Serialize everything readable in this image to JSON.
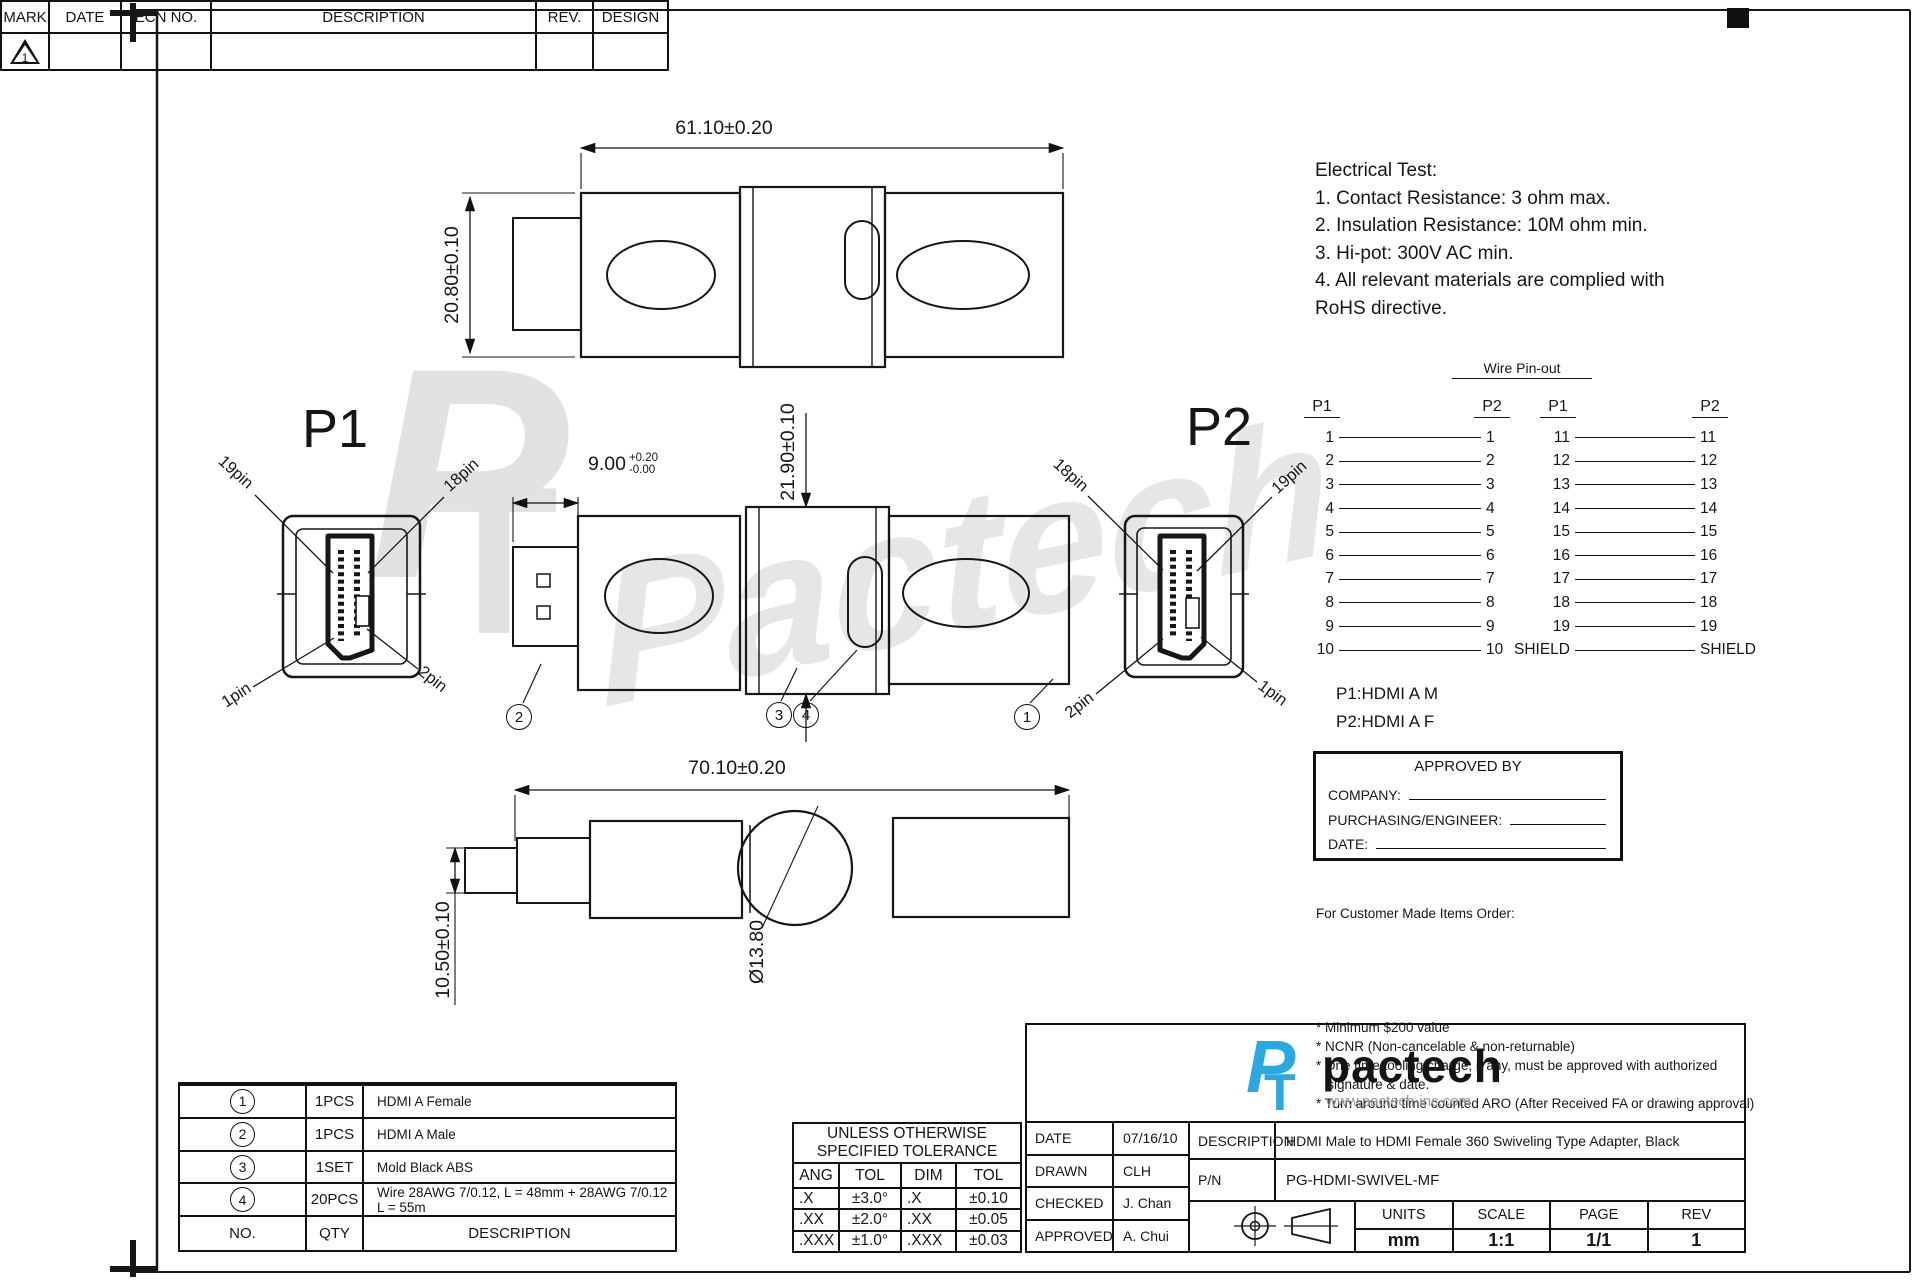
{
  "revision_table": {
    "headers": [
      "MARK",
      "DATE",
      "ECN NO.",
      "DESCRIPTION",
      "REV.",
      "DESIGN"
    ],
    "mark_value": "1"
  },
  "electrical_test": {
    "title": "Electrical Test:",
    "lines": [
      "1. Contact Resistance: 3 ohm max.",
      "2. Insulation Resistance: 10M ohm min.",
      "3. Hi-pot: 300V AC min.",
      "4. All relevant materials are complied with",
      "RoHS directive."
    ]
  },
  "views": {
    "p1_label": "P1",
    "p2_label": "P2",
    "p1_pins": {
      "top_left": "19pin",
      "top_right": "18pin",
      "bottom_left": "1pin",
      "bottom_right": "2pin"
    },
    "p2_pins": {
      "top_left": "18pin",
      "top_right": "19pin",
      "bottom_left": "2pin",
      "bottom_right": "1pin"
    },
    "dims": {
      "top_length": "61.10±0.20",
      "front_height": "20.80±0.10",
      "plug_main": "9.00",
      "plug_tol_up": "+0.20",
      "plug_tol_dn": "-0.00",
      "joint_height": "21.90±0.10",
      "overall_length": "70.10±0.20",
      "tail_height": "10.50±0.10",
      "knob_dia": "Ø13.80"
    },
    "balloons": {
      "b1": "1",
      "b2": "2",
      "b3": "3",
      "b4": "4"
    }
  },
  "wire_pinout": {
    "title": "Wire Pin-out",
    "headers": {
      "left_a": "P1",
      "right_a": "P2",
      "left_b": "P1",
      "right_b": "P2"
    },
    "group_a": [
      {
        "l": "1",
        "r": "1"
      },
      {
        "l": "2",
        "r": "2"
      },
      {
        "l": "3",
        "r": "3"
      },
      {
        "l": "4",
        "r": "4"
      },
      {
        "l": "5",
        "r": "5"
      },
      {
        "l": "6",
        "r": "6"
      },
      {
        "l": "7",
        "r": "7"
      },
      {
        "l": "8",
        "r": "8"
      },
      {
        "l": "9",
        "r": "9"
      },
      {
        "l": "10",
        "r": "10"
      }
    ],
    "group_b": [
      {
        "l": "11",
        "r": "11"
      },
      {
        "l": "12",
        "r": "12"
      },
      {
        "l": "13",
        "r": "13"
      },
      {
        "l": "14",
        "r": "14"
      },
      {
        "l": "15",
        "r": "15"
      },
      {
        "l": "16",
        "r": "16"
      },
      {
        "l": "17",
        "r": "17"
      },
      {
        "l": "18",
        "r": "18"
      },
      {
        "l": "19",
        "r": "19"
      },
      {
        "l": "SHIELD",
        "r": "SHIELD"
      }
    ],
    "legend_p1": "P1:HDMI A M",
    "legend_p2": "P2:HDMI A F"
  },
  "approval": {
    "title": "APPROVED BY",
    "company_label": "COMPANY:",
    "purchasing_label": "PURCHASING/ENGINEER:",
    "date_label": "DATE:"
  },
  "order_notes": {
    "title": "For Customer Made Items Order:",
    "items": [
      "* Minimum $200 value",
      "* NCNR (Non-cancelable & non-returnable)",
      "* One time tooling charge, if any, must be approved with authorized",
      "   signature & date.",
      "* Turn around time counted ARO (After Received FA or drawing approval)"
    ]
  },
  "bom": {
    "rows": [
      {
        "no": "4",
        "qty": "20PCS",
        "desc": "Wire 28AWG 7/0.12, L = 48mm + 28AWG 7/0.12 L = 55m"
      },
      {
        "no": "3",
        "qty": "1SET",
        "desc": "Mold Black ABS"
      },
      {
        "no": "2",
        "qty": "1PCS",
        "desc": "HDMI A Male"
      },
      {
        "no": "1",
        "qty": "1PCS",
        "desc": "HDMI A Female"
      }
    ],
    "footer": {
      "no": "NO.",
      "qty": "QTY",
      "desc": "DESCRIPTION"
    }
  },
  "tolerance_table": {
    "title_line1": "UNLESS OTHERWISE",
    "title_line2": "SPECIFIED TOLERANCE",
    "headers": [
      "ANG",
      "TOL",
      "DIM",
      "TOL"
    ],
    "rows": [
      {
        "ang": ".X",
        "angtol": "±3.0°",
        "dim": ".X",
        "dimtol": "±0.10"
      },
      {
        "ang": ".XX",
        "angtol": "±2.0°",
        "dim": ".XX",
        "dimtol": "±0.05"
      },
      {
        "ang": ".XXX",
        "angtol": "±1.0°",
        "dim": ".XXX",
        "dimtol": "±0.03"
      }
    ]
  },
  "title_block": {
    "logo_mark_p": "P",
    "logo_mark_t": "T",
    "logo_text": "pactech",
    "logo_url": "www.pactech-inc.com",
    "brand_color": "#29a9e0",
    "date_label": "DATE",
    "date": "07/16/10",
    "drawn_label": "DRAWN",
    "drawn": "CLH",
    "checked_label": "CHECKED",
    "checked": "J. Chan",
    "approved_label": "APPROVED",
    "approved": "A. Chui",
    "description_label": "DESCRIPTION",
    "description": "HDMI Male to HDMI Female 360 Swiveling Type Adapter, Black",
    "pn_label": "P/N",
    "pn": "PG-HDMI-SWIVEL-MF",
    "units_label": "UNITS",
    "units": "mm",
    "scale_label": "SCALE",
    "scale": "1:1",
    "page_label": "PAGE",
    "page": "1/1",
    "rev_label": "REV",
    "rev": "1"
  },
  "watermark": {
    "mark_p": "P",
    "mark_t": "T",
    "script": "Pactech"
  }
}
